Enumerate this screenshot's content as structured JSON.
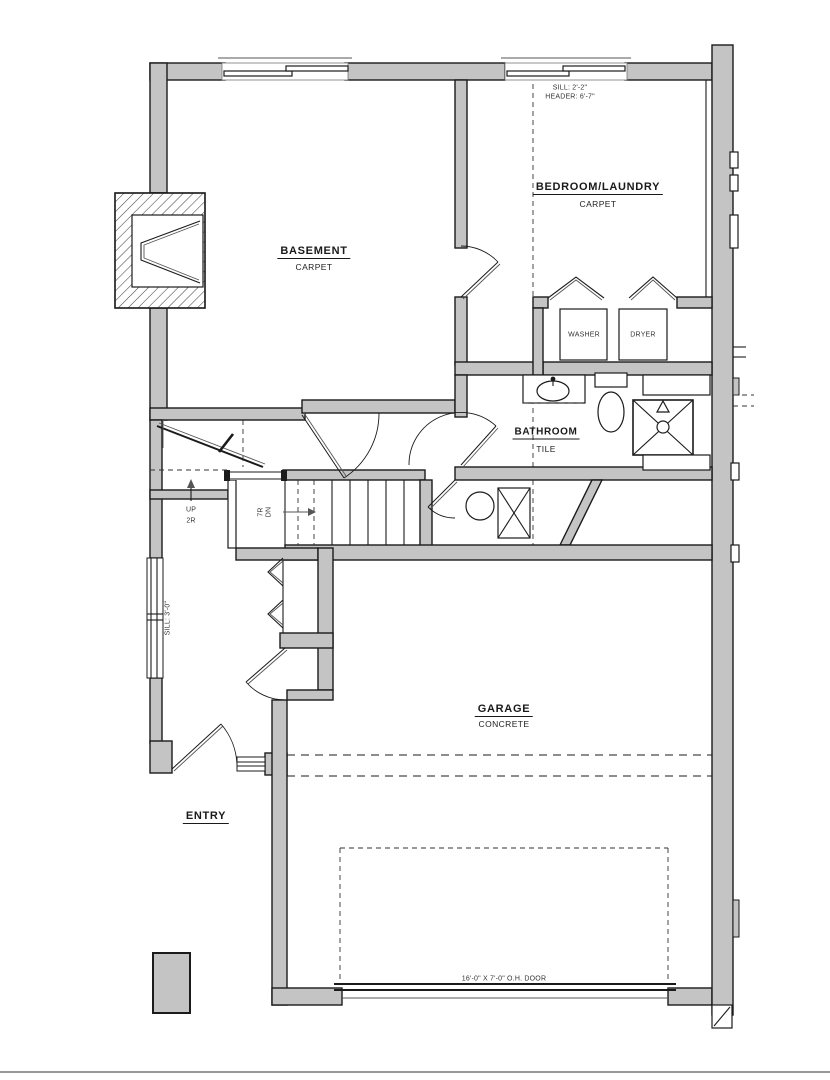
{
  "plan": {
    "rooms": {
      "basement": {
        "name": "BASEMENT",
        "floor": "CARPET"
      },
      "bedroom_laundry": {
        "name": "BEDROOM/LAUNDRY",
        "floor": "CARPET"
      },
      "bathroom": {
        "name": "BATHROOM",
        "floor": "TILE"
      },
      "garage": {
        "name": "GARAGE",
        "floor": "CONCRETE"
      },
      "entry": {
        "name": "ENTRY"
      }
    },
    "appliances": {
      "washer": "WASHER",
      "dryer": "DRYER"
    },
    "stairs": {
      "up_label": "UP",
      "up_risers": "2R",
      "down_risers": "7R",
      "down_label": "DN"
    },
    "notes": {
      "bedroom_window_sill": "SILL: 2'-2\"",
      "bedroom_window_header": "HEADER: 6'-7\"",
      "entry_window_sill": "SILL: 3'-0\"",
      "garage_door": "16'-0\" X 7'-0\" O.H. DOOR"
    },
    "colors": {
      "wall_fill": "#c4c4c4",
      "line": "#1b1b1b",
      "background": "#ffffff"
    }
  }
}
